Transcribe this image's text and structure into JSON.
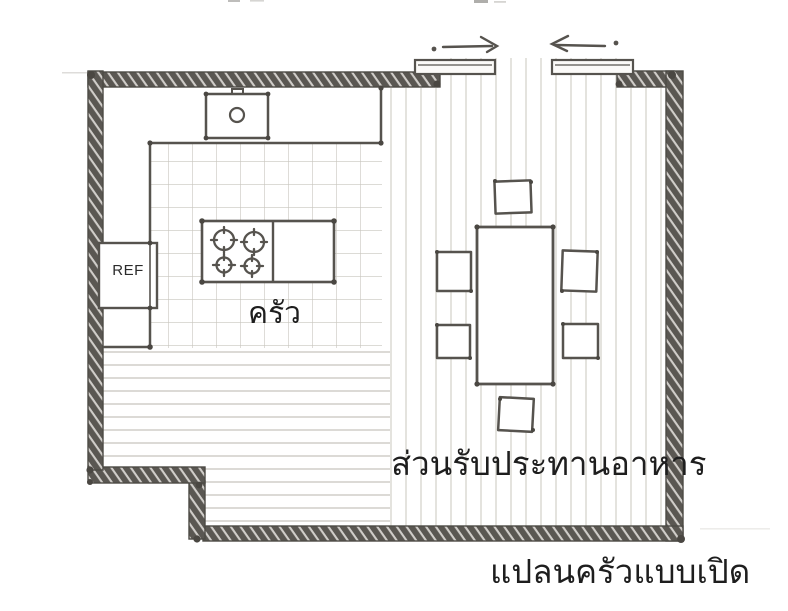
{
  "plan": {
    "caption": "แปลนครัวแบบเปิด",
    "kitchen": {
      "label": "ครัว",
      "floor": "ceramic-tile-grid",
      "fixtures": [
        "sink",
        "cooktop-4-burners",
        "l-shaped-counter",
        "refrigerator"
      ]
    },
    "dining": {
      "label": "ส่วนรับประทานอาหาร",
      "floor": "wood-planks",
      "furniture": [
        "dining-table",
        "chair",
        "chair",
        "chair",
        "chair",
        "chair",
        "chair"
      ]
    },
    "refrigerator_label": "REF",
    "door": {
      "type": "sliding-double-door",
      "indicators": [
        "slide-arrow-left-leaf",
        "slide-arrow-right-leaf"
      ]
    }
  },
  "colors": {
    "ink": "#56534e",
    "wall_fill": "#5a5752",
    "text": "#1e1e1e",
    "tile_line": "#c8c5bd",
    "plank_line": "#d6d4cd",
    "floor_line": "#c5c2ba",
    "background": "#ffffff"
  }
}
